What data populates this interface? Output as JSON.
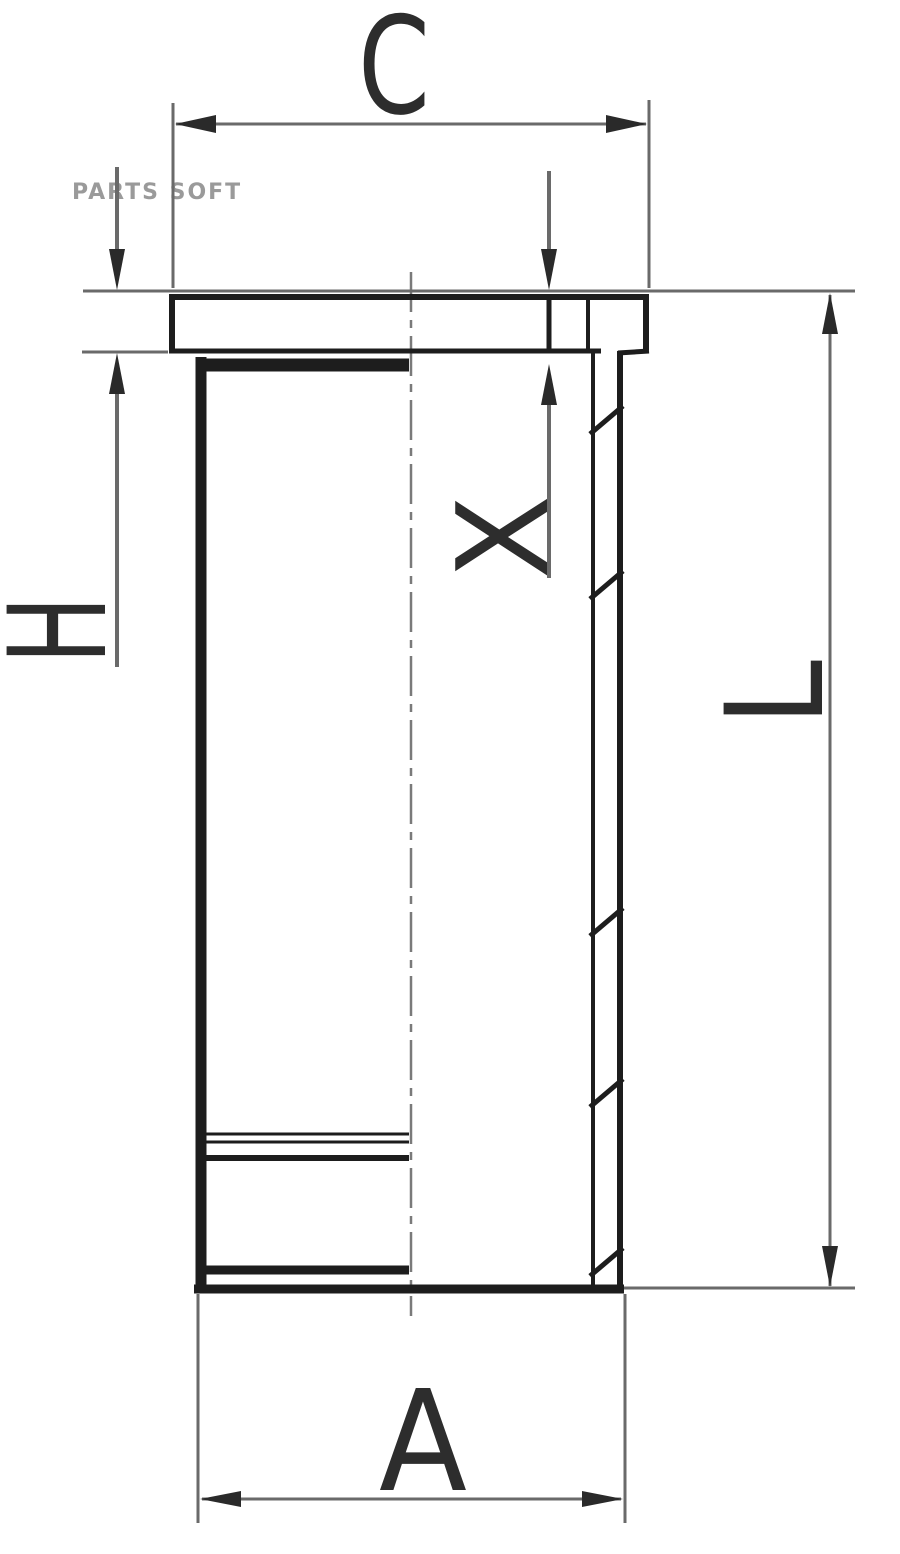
{
  "watermark": "PARTS SOFT",
  "drawing": {
    "type": "cylinder-liner-technical-drawing",
    "dimension_labels": {
      "collar_outer_diameter": "C",
      "collar_height": "H",
      "recess_depth": "X",
      "total_length": "L",
      "lower_outer_diameter": "A"
    }
  },
  "colors": {
    "background": "#ffffff",
    "outline": "#1d1d1d",
    "dimension_line": "#6a6a6a",
    "arrow": "#2a2a2a",
    "centerline": "#7a7a7a",
    "label_text": "#2d2d2d",
    "watermark": "#9a9a9a"
  }
}
